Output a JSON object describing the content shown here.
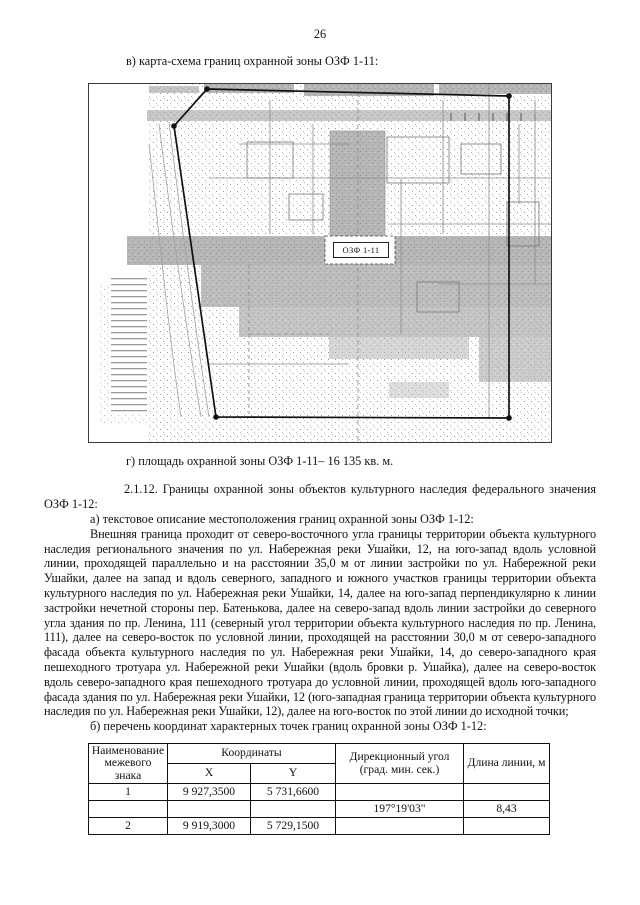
{
  "page": {
    "number": "26"
  },
  "sections": {
    "map_heading": "в) карта-схема границ охранной зоны ОЗФ 1-11:",
    "area_caption": "г) площадь охранной зоны ОЗФ 1-11– 16 135 кв. м.",
    "clause_2_1_12": "2.1.12. Границы охранной зоны объектов культурного наследия федерального значения ОЗФ 1-12:",
    "item_a": "а) текстовое описание местоположения границ охранной зоны ОЗФ 1-12:",
    "description": "Внешняя граница проходит от северо-восточного угла границы территории объекта культурного наследия регионального значения по ул. Набережная реки Ушайки, 12, на юго-запад вдоль условной линии, проходящей параллельно и на расстоянии 35,0 м от линии застройки по ул. Набережной реки Ушайки, далее на запад и вдоль северного, западного и южного участков границы территории объекта культурного наследия по ул. Набережная реки Ушайки, 14, далее на юго-запад перпендикулярно к линии застройки нечетной стороны пер. Батенькова, далее на северо-запад вдоль линии застройки до северного угла здания по пр. Ленина, 111 (северный угол территории объекта культурного наследия по пр. Ленина, 111), далее на северо-восток по условной линии, проходящей на расстоянии 30,0 м от северо-западного фасада объекта культурного наследия по ул. Набережная реки Ушайки, 14, до северо-западного края пешеходного тротуара ул. Набережной реки Ушайки (вдоль бровки р. Ушайка), далее на северо-восток вдоль северо-западного края пешеходного тротуара до условной линии, проходящей вдоль юго-западного фасада здания по ул. Набережная реки Ушайки, 12 (юго-западная граница территории объекта культурного наследия по ул. Набережная реки Ушайки, 12), далее на юго-восток по этой линии до исходной точки;",
    "item_b": "б) перечень координат характерных точек границ охранной зоны ОЗФ 1-12:"
  },
  "map": {
    "zone_label": "ОЗФ 1-11"
  },
  "table": {
    "col_name": "Наименование межевого знака",
    "col_coords": "Координаты",
    "col_x": "X",
    "col_y": "Y",
    "col_angle": "Дирекционный угол (град. мин. сек.)",
    "col_length": "Длина линии, м",
    "rows": [
      [
        "1",
        "9 927,3500",
        "5 731,6600",
        "",
        ""
      ],
      [
        "",
        "",
        "",
        "197°19'03\"",
        "8,43"
      ],
      [
        "2",
        "9 919,3000",
        "5 729,1500",
        "",
        ""
      ]
    ]
  }
}
